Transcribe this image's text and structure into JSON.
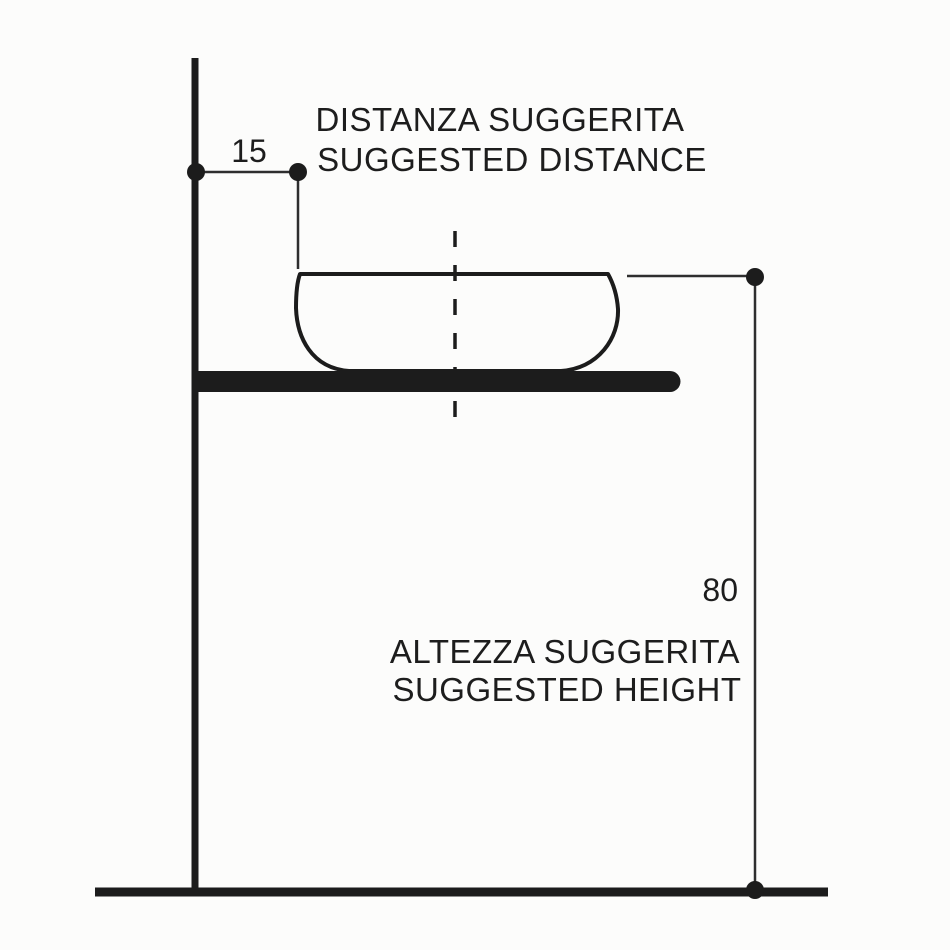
{
  "diagram": {
    "colors": {
      "ink": "#1c1c1c",
      "thin_line": "#2e2e2e",
      "background": "#fcfcfb"
    },
    "distance_annotation": {
      "value": "15",
      "label_line1": "DISTANZA SUGGERITA",
      "label_line2": "SUGGESTED DISTANCE"
    },
    "height_annotation": {
      "value": "80",
      "label_line1": "ALTEZZA SUGGERITA",
      "label_line2": "SUGGESTED HEIGHT"
    }
  }
}
